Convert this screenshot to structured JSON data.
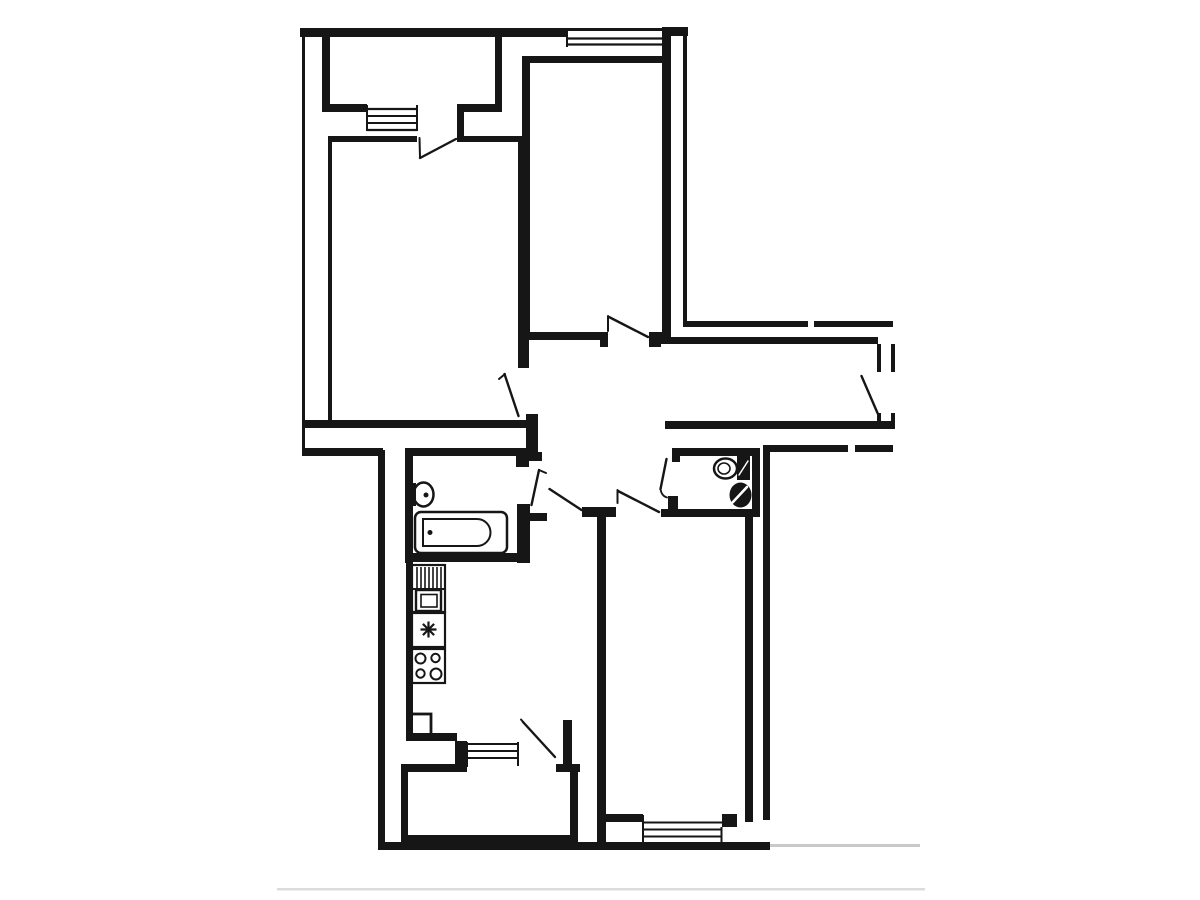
{
  "palette": {
    "background": "#ffffff",
    "wall": "#161616",
    "faint_boundary": "#c9c9c9",
    "footer_divider": "#dcdcdc"
  },
  "plan": {
    "kind": "Black-and-white apartment floor plan line drawing, no text labels",
    "rooms": [
      {
        "id": "loggia-top",
        "label": "Top balcony (loggia) of living room"
      },
      {
        "id": "living-room",
        "label": "Living room (top left) with balcony exit"
      },
      {
        "id": "bedroom-2",
        "label": "Bedroom (top middle) with top window"
      },
      {
        "id": "corridor",
        "label": "Entrance hall / corridor with entrance door on right"
      },
      {
        "id": "bathroom",
        "label": "Bathroom with bathtub and washbasin"
      },
      {
        "id": "wc",
        "label": "WC with toilet and washbasin"
      },
      {
        "id": "kitchen",
        "label": "Kitchen with sink unit, water heater, stove and fridge"
      },
      {
        "id": "bedroom-3",
        "label": "Bedroom (bottom right) with bottom window"
      },
      {
        "id": "loggia-bottom",
        "label": "Kitchen balcony (loggia) at bottom"
      }
    ],
    "fixtures": [
      {
        "id": "bathtub",
        "label": "Bathtub"
      },
      {
        "id": "bathroom-basin",
        "label": "Bathroom washbasin"
      },
      {
        "id": "toilet",
        "label": "Toilet with cistern"
      },
      {
        "id": "wc-basin",
        "label": "WC washbasin"
      },
      {
        "id": "kitchen-sink",
        "label": "Kitchen sink unit with drainboard"
      },
      {
        "id": "water-heater",
        "label": "Water heater / vent unit (star symbol)"
      },
      {
        "id": "stove",
        "label": "Four-burner stove"
      },
      {
        "id": "fridge",
        "label": "Refrigerator"
      }
    ],
    "windows": [
      {
        "id": "loggia-top-window",
        "label": "Window between living room and top balcony"
      },
      {
        "id": "bedroom-2-window",
        "label": "Bedroom top exterior window"
      },
      {
        "id": "kitchen-window",
        "label": "Kitchen window to bottom balcony"
      },
      {
        "id": "bedroom-3-window",
        "label": "Bedroom bottom exterior window"
      }
    ],
    "doors": [
      {
        "id": "loggia-top-door",
        "label": "Balcony door from living room"
      },
      {
        "id": "living-room-door",
        "label": "Living room door to hall"
      },
      {
        "id": "bedroom-2-door",
        "label": "Top bedroom door to hall"
      },
      {
        "id": "entrance-door",
        "label": "Apartment entrance door"
      },
      {
        "id": "bathroom-door",
        "label": "Bathroom door"
      },
      {
        "id": "wc-door",
        "label": "WC door"
      },
      {
        "id": "kitchen-door",
        "label": "Kitchen doorway"
      },
      {
        "id": "bedroom-3-door",
        "label": "Bottom bedroom door"
      },
      {
        "id": "loggia-bottom-door",
        "label": "Balcony door from kitchen"
      }
    ]
  }
}
